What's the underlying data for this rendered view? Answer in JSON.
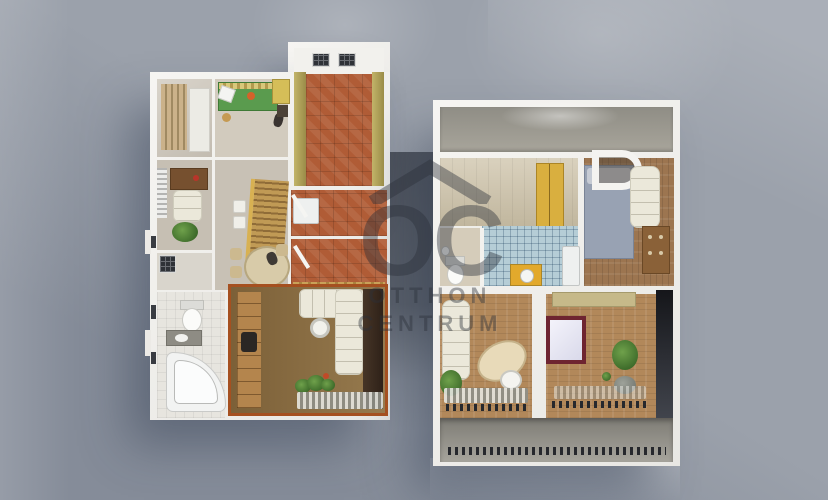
{
  "watermark": {
    "monogram": "OC",
    "line1": "OTTHON",
    "line2": "CENTRUM",
    "logo_icon": "house-roof-icon"
  },
  "palette": {
    "bg-base": "#9ba1ab",
    "wall": "#f3f2ee",
    "terracotta": "#b05c36",
    "wood-floor": "#b2885a",
    "wood-dark": "#8a6138",
    "kitchen-tile": "#b5cdd6",
    "accent-yellow": "#d9af3f",
    "bed-green": "#5a9b4e",
    "bed-blue": "#98a2b3",
    "sofa-cream": "#ebe8da",
    "frame-burgundy": "#6e2430",
    "door-orange": "#a55020",
    "plant-green": "#4a7a34",
    "terrace-gray": "#8f8d85",
    "wm": "rgba(42,48,58,0.42)",
    "shadow": "rgba(44,54,76,0.42)"
  }
}
